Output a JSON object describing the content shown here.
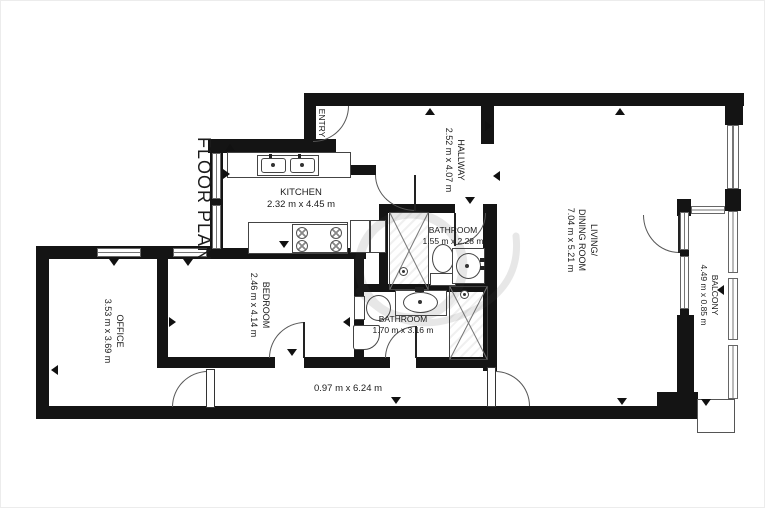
{
  "title": "FLOOR PLAN",
  "colors": {
    "wall": "#141414",
    "floor": "#ffffff",
    "text": "#1b1b1b",
    "window_line": "#777777",
    "watermark": "#444444"
  },
  "rooms": {
    "entry": {
      "name": "ENTRY"
    },
    "kitchen": {
      "name": "KITCHEN",
      "dims": "2.32 m x 4.45 m"
    },
    "hallway": {
      "name": "HALLWAY",
      "dims": "2.52 m x 4.07 m"
    },
    "living_dining": {
      "name_line1": "LIVING/",
      "name_line2": "DINING ROOM",
      "dims": "7.04 m x 5.21 m"
    },
    "balcony": {
      "name": "BALCONY",
      "dims": "4.49 m x 0.85 m"
    },
    "bathroom_small": {
      "name": "BATHROOM",
      "dims": "1.55 m x 2.28 m"
    },
    "bathroom_large": {
      "name": "BATHROOM",
      "dims": "1.70 m x 3.16 m"
    },
    "bedroom": {
      "name": "BEDROOM",
      "dims": "2.46 m x 4.14 m"
    },
    "office": {
      "name": "OFFICE",
      "dims": "3.53 m x 3.69 m"
    },
    "corridor": {
      "dims": "0.97 m x 6.24 m"
    }
  }
}
